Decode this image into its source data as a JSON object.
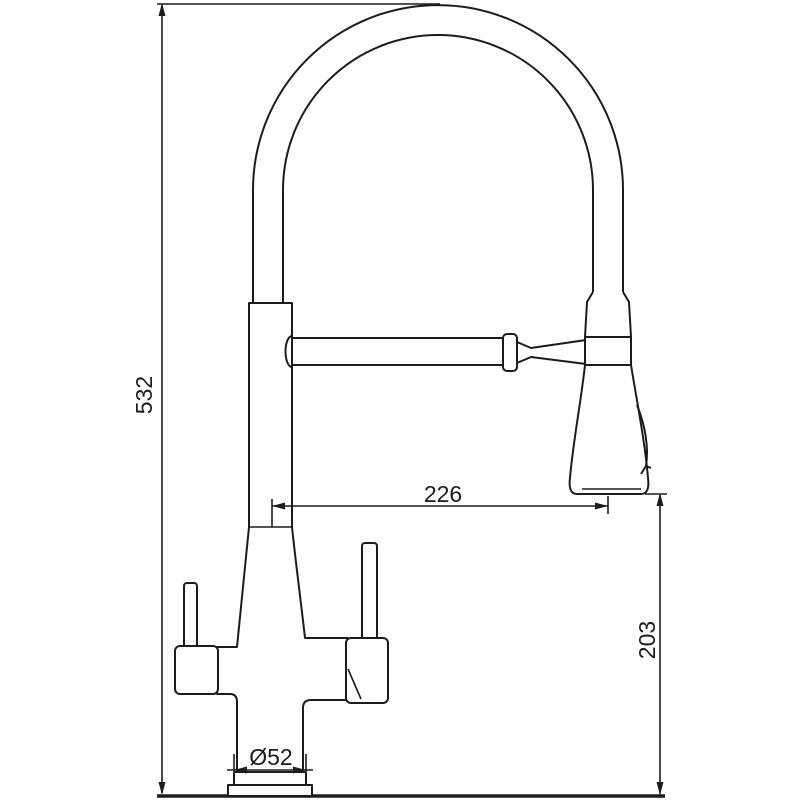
{
  "drawing": {
    "kind": "faucet-dimension-diagram",
    "colors": {
      "line": "#1c1c1c",
      "background": "#ffffff"
    },
    "dimensions": {
      "overall_height": {
        "label": "532",
        "value": 532
      },
      "spout_reach": {
        "label": "226",
        "value": 226
      },
      "head_to_deck": {
        "label": "203",
        "value": 203
      },
      "base_diameter": {
        "label": "Ø52",
        "value": 52
      }
    }
  }
}
